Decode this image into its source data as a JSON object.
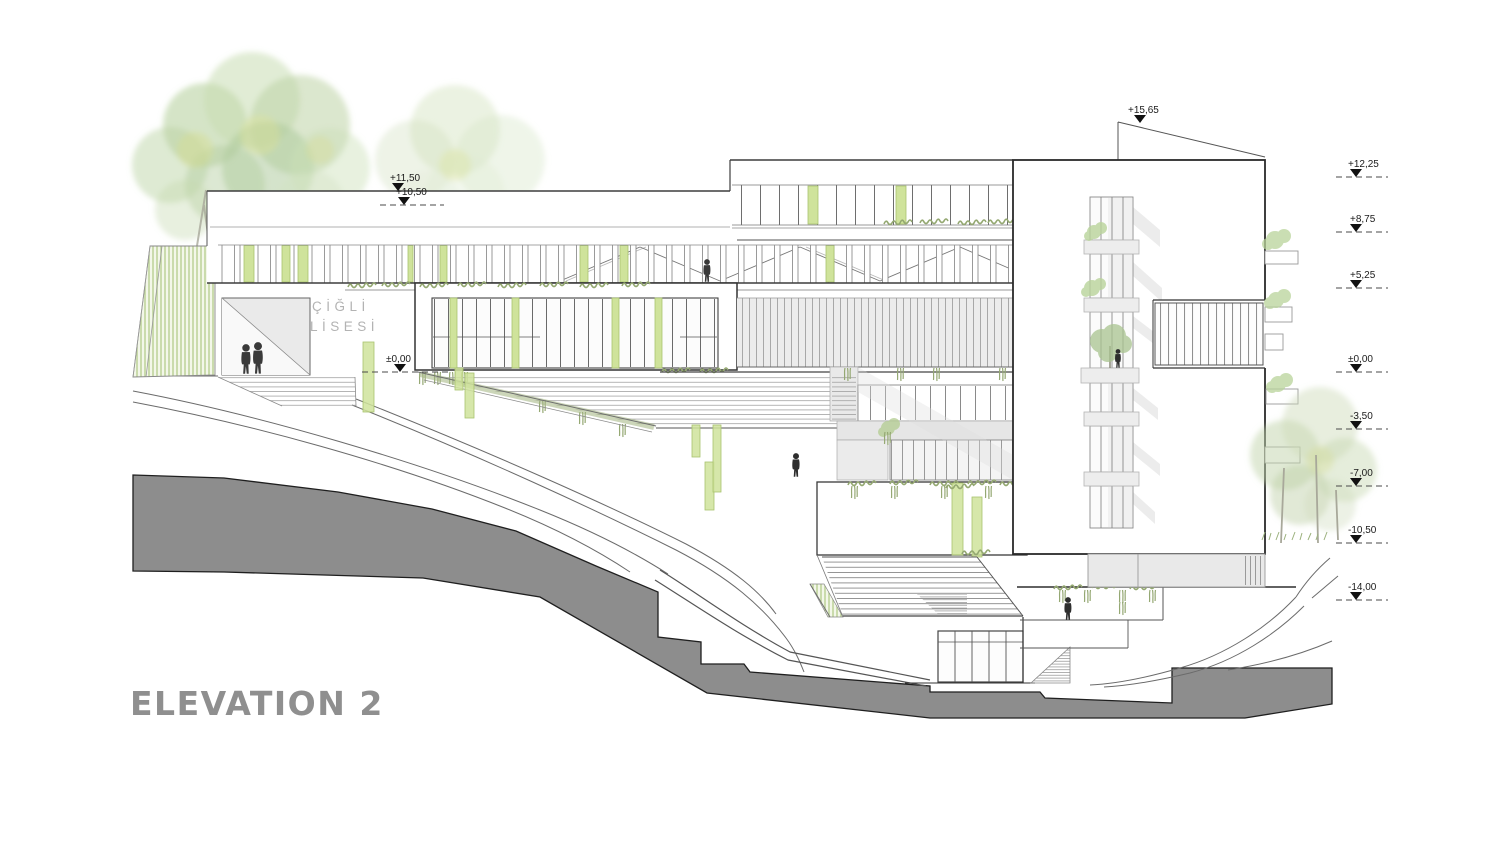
{
  "title": "ELEVATION 2",
  "sign": {
    "line1": "ÇİĞLİ",
    "line2": "LİSESİ"
  },
  "markers": {
    "top": "+15,65",
    "left": [
      "+11,50",
      "+10,50"
    ],
    "mid": "±0,00",
    "right": [
      "+12,25",
      "+8,75",
      "+5,25",
      "±0,00",
      "-3,50",
      "-7,00",
      "-10,50",
      "-14,00"
    ]
  },
  "colors": {
    "accent_green": "#cfe39b",
    "accent_green_border": "#a9c46f",
    "vegetation": "#94a871",
    "terrain_gray": "#8d8d8d",
    "panel_gray": "#ececec",
    "line_dark": "#3c3c3c",
    "title_gray": "#8f8f8f",
    "sign_gray": "#b3b3b3"
  }
}
